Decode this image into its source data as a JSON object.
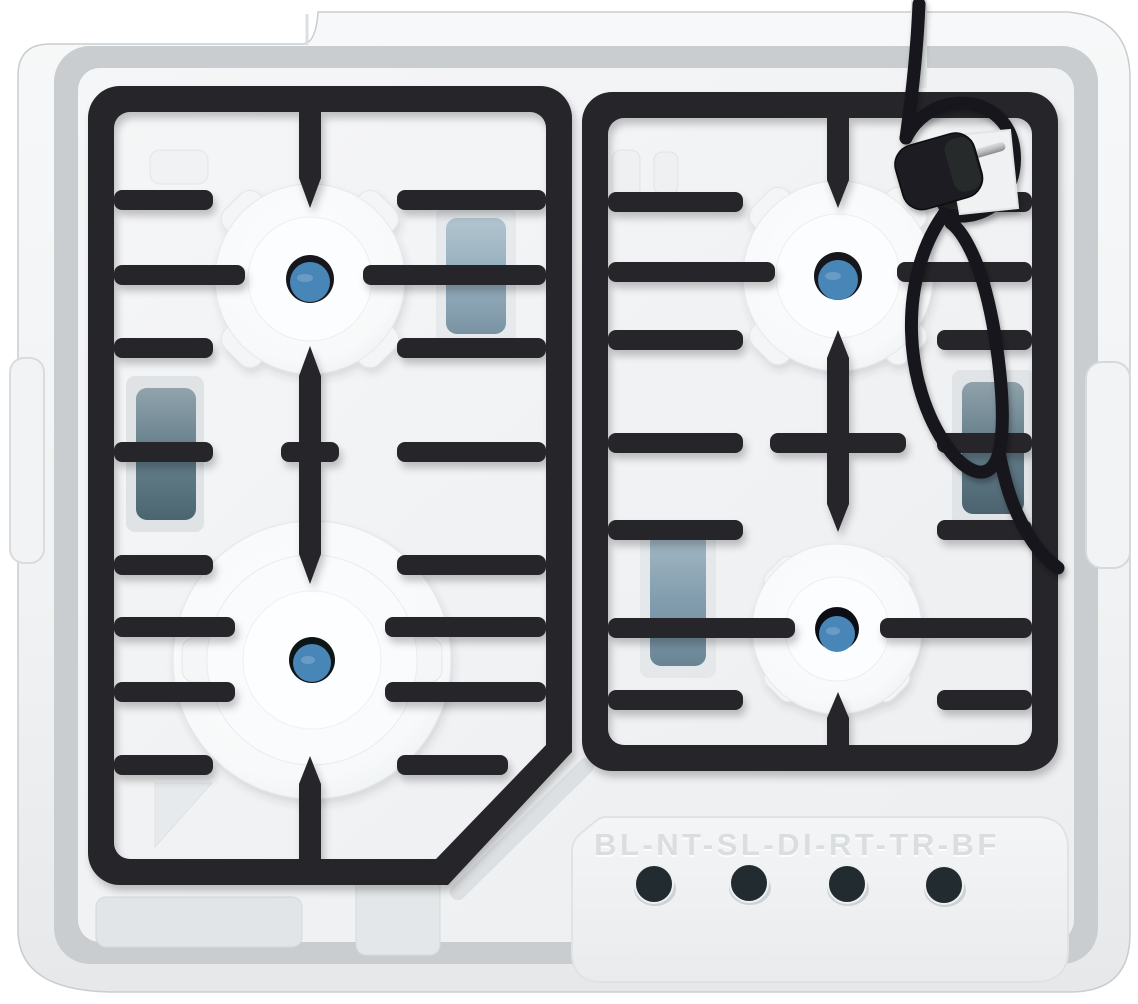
{
  "scene": {
    "type": "product-photo",
    "subject": "Top view of a four-burner gas hob packed in a white styrofoam tray",
    "objects": [
      "white styrofoam packaging tray",
      "two black cast-iron pan-support grates",
      "four styrofoam burner protectors with blue burner caps",
      "coiled black power cord with Schuko plug",
      "embossed model code on lower foam panel",
      "four dark control-valve holes"
    ]
  },
  "packaging": {
    "embossed_text": "BL-NT-SL-DI-RT-TR-BF",
    "valve_hole_count": 4
  },
  "burners": [
    {
      "name": "top-left",
      "size": "standard"
    },
    {
      "name": "top-right",
      "size": "standard"
    },
    {
      "name": "bottom-left",
      "size": "wok-large"
    },
    {
      "name": "bottom-right",
      "size": "small"
    }
  ],
  "colors": {
    "foam": "#f2f4f5",
    "foam_shadow": "#c9cdd0",
    "grate": "#26282a",
    "burner_cap_blue": "#4a86b8",
    "cord_black": "#17181a",
    "plug_pin_silver": "#c3c7c9",
    "hole_dark": "#222b30",
    "windows": {
      "left_edge": "#55727f",
      "center_left": "#8aa6b7",
      "center_right": "#7795a7",
      "right_edge": "#54707d"
    }
  }
}
